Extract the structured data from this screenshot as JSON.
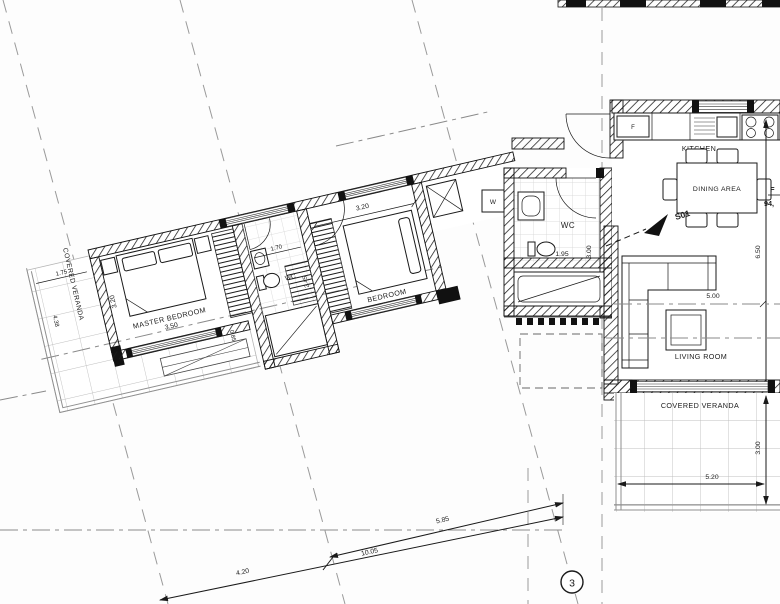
{
  "plan": {
    "rooms": {
      "master_bedroom": {
        "label": "MASTER BEDROOM",
        "width": "3.50",
        "depth": "3.20"
      },
      "bedroom": {
        "label": "BEDROOM",
        "width": "3.20"
      },
      "wc_small": {
        "label": "WC",
        "width": "1.70",
        "depth": "2.45"
      },
      "wc_entry": {
        "label": "WC",
        "width": "1.95",
        "depth": "3.00"
      },
      "kitchen": {
        "label": "KITCHEN"
      },
      "dining": {
        "label": "DINING AREA"
      },
      "living": {
        "label": "LIVING ROOM",
        "width": "5.00",
        "depth": "6.50"
      },
      "veranda_left": {
        "label": "COVERED VERANDA",
        "top_dim": "1.75",
        "side_dim": "4.38",
        "strip_dim": "0.85"
      },
      "veranda_right": {
        "label": "COVERED VERANDA",
        "width": "5.20",
        "depth": "3.00"
      }
    },
    "appliances": {
      "fridge": "F",
      "washer": "W"
    },
    "markers": {
      "section_label": "S01",
      "grid_bubble": "3"
    },
    "flat": {
      "line1": "F",
      "line2": "94,"
    },
    "dims": {
      "bottom_left": "4.20",
      "bottom_mid": "10.05",
      "bottom_right": "5.85"
    },
    "colors": {
      "ink": "#1a1a1a",
      "grid": "#999999",
      "tile": "#c0c0c0"
    }
  }
}
